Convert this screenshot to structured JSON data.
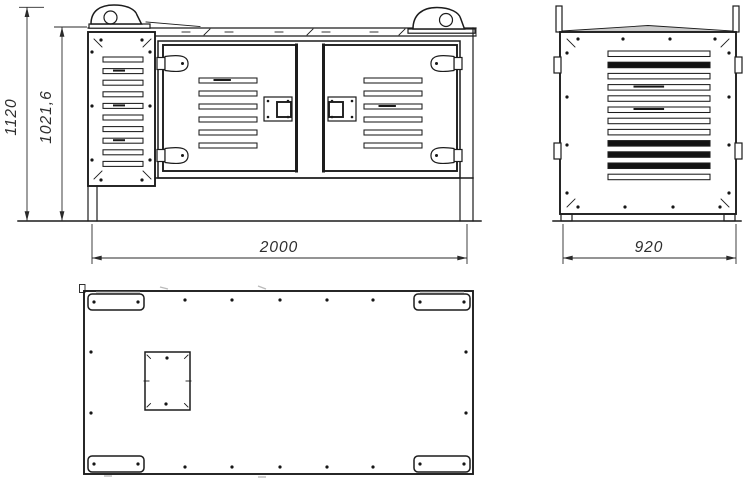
{
  "dimensions": {
    "overall_height": "1120",
    "enclosure_height": "1021,6",
    "length": "2000",
    "depth": "920"
  },
  "views": {
    "front": {
      "intake_panel_slats": 10,
      "door_slats": 6,
      "doors": 2,
      "hinges": 4,
      "latches": 2,
      "lifting_lugs": 2
    },
    "side": {
      "slats": 12,
      "dark_slats": 4,
      "edge_brackets": 4
    },
    "bottom": {
      "corner_mounting_plates": 4,
      "plate_holes": 8,
      "edge_holes_top_row": 5,
      "edge_holes_bottom_row": 5,
      "edge_holes_sides": 4,
      "cutout_openings": 1,
      "cutout_holes": 2
    }
  },
  "colors": {
    "line": "#1c1c1c",
    "dim": "#2a2a2a",
    "background": "#ffffff",
    "shade": "#b9b9b9"
  }
}
